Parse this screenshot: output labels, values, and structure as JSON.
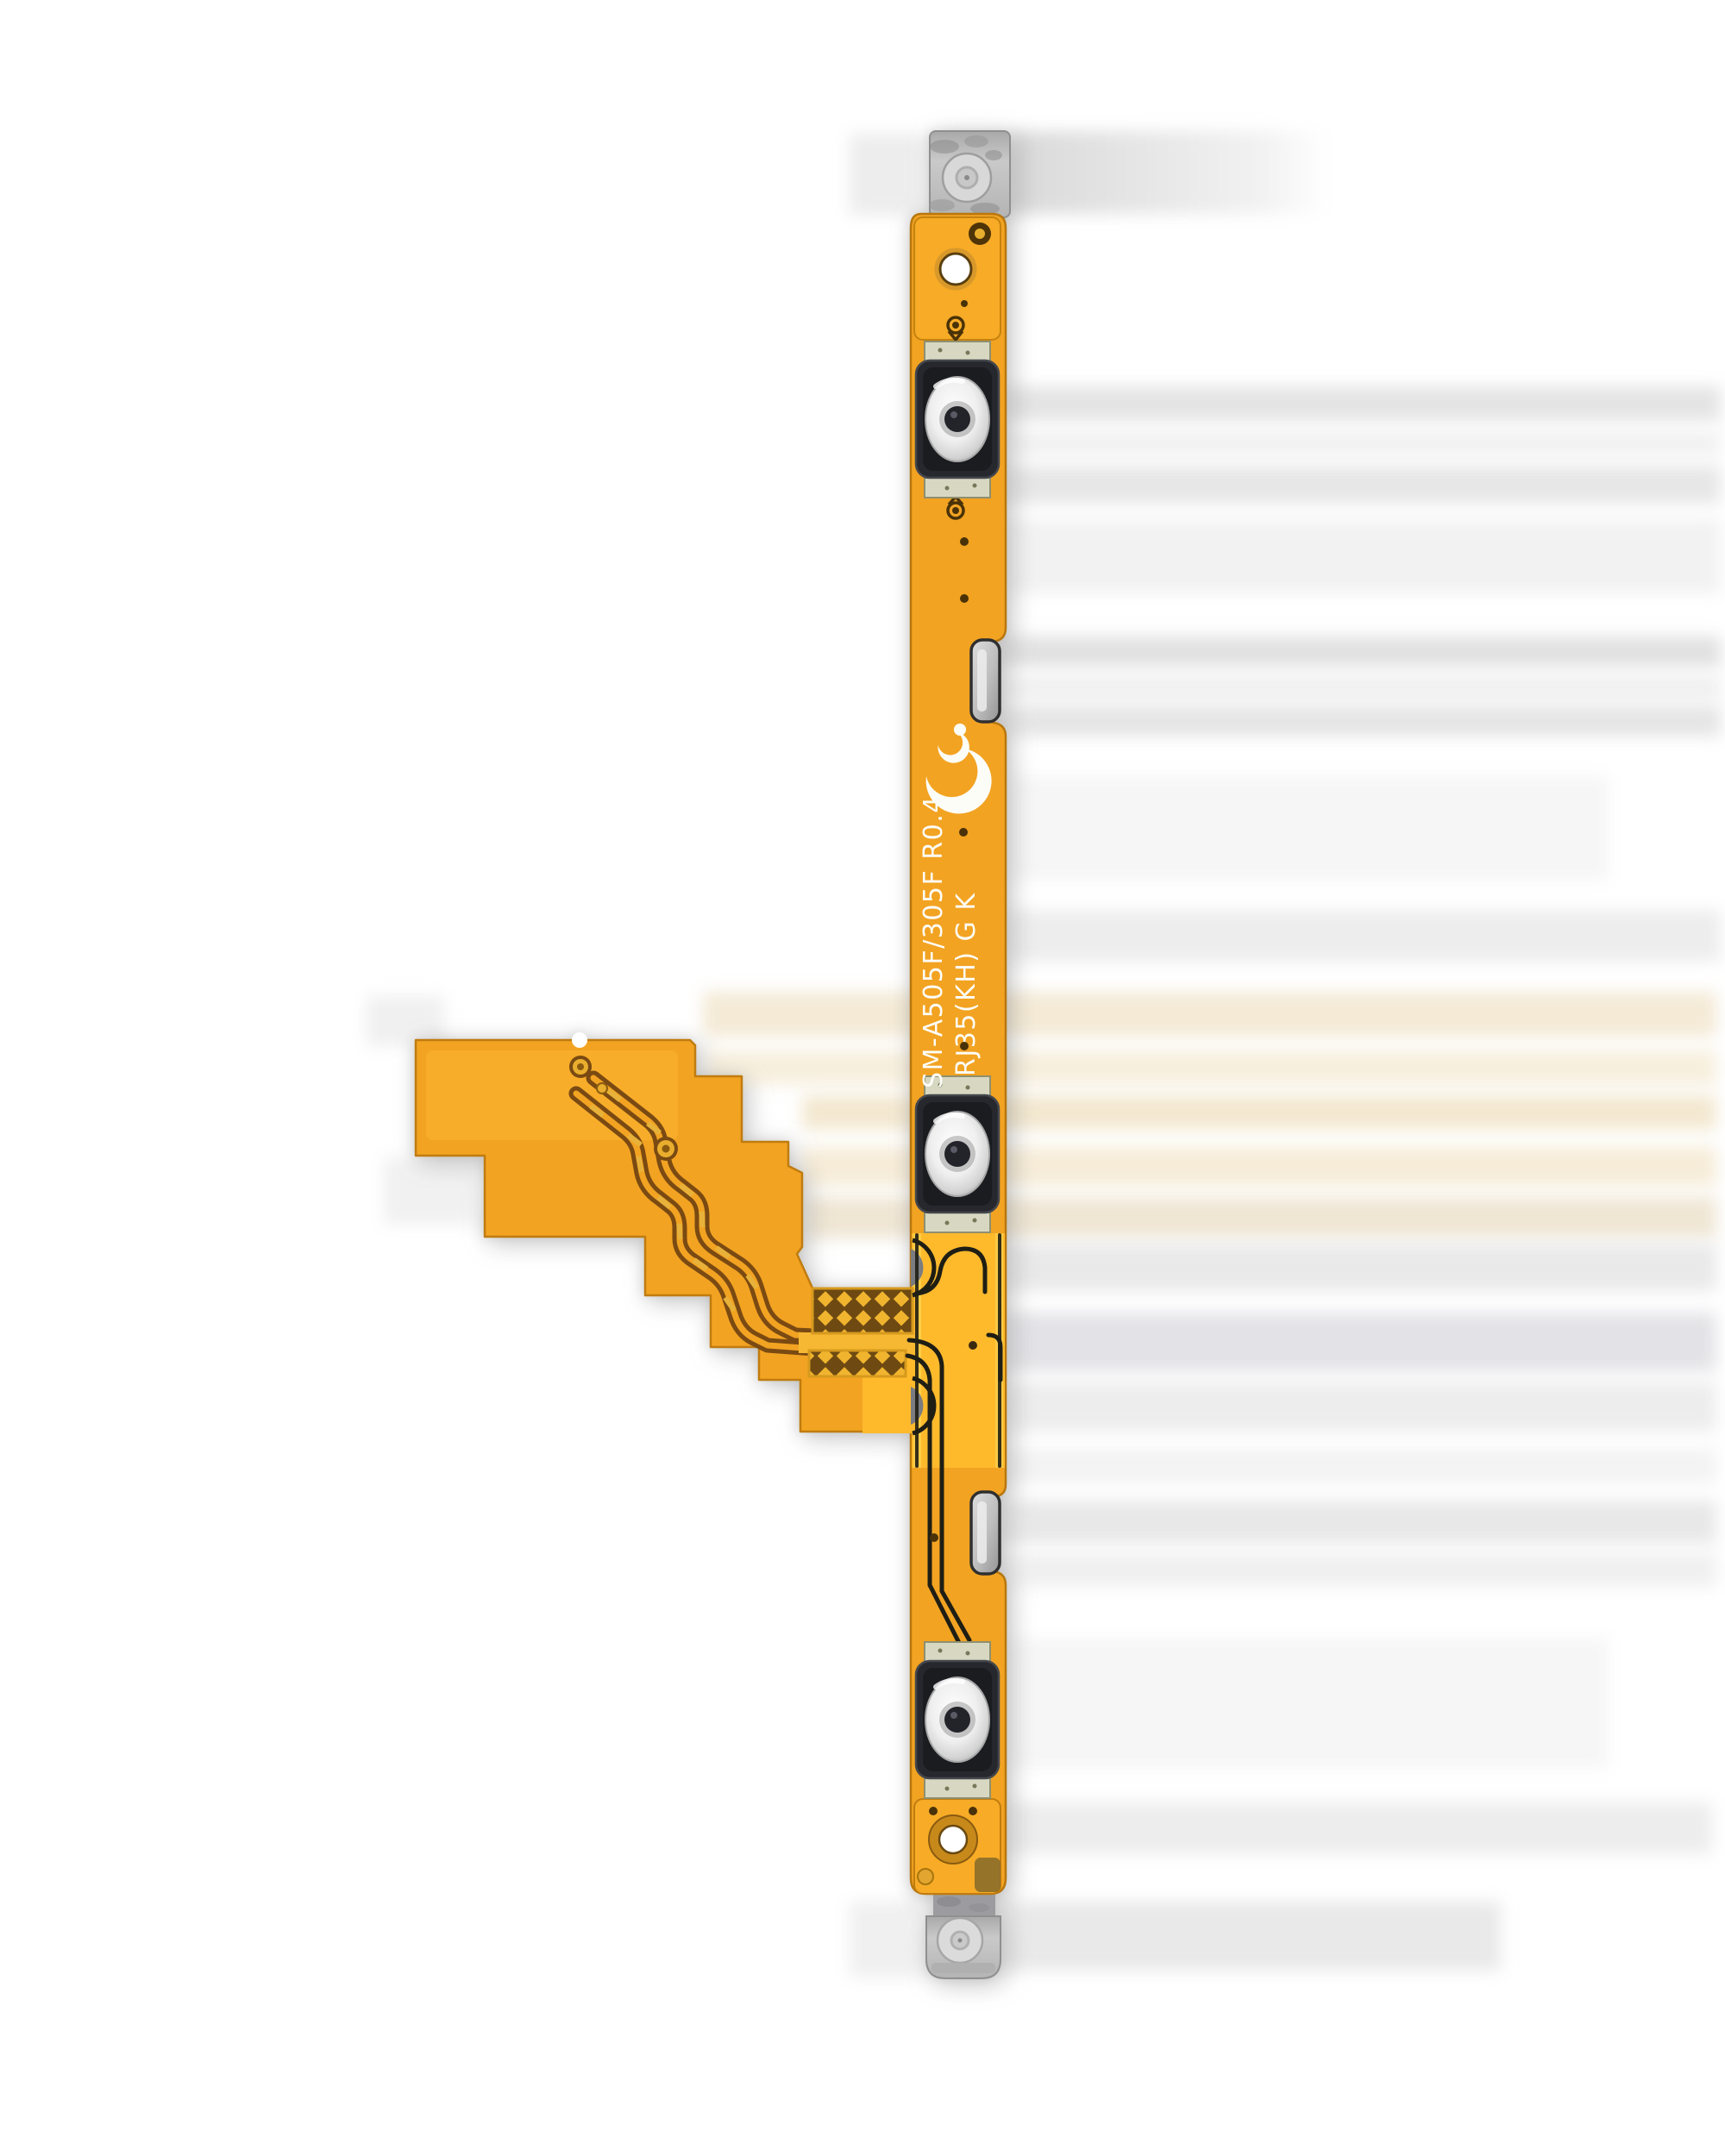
{
  "photo": {
    "subject": "Power and volume side-key flex cable",
    "silkscreen": {
      "line1": "SM-A505F/305F R0.4",
      "line2": "RJ35(KH) G K"
    },
    "features": {
      "dome_switch_count": "3",
      "mounting_bracket_count": "2",
      "side_contact_clip_count": "2"
    },
    "colors": {
      "flex_orange": "#F2A322",
      "flex_gold": "#FFBA2C",
      "trace_brown": "#7A4A12",
      "silkscreen_white": "#FDFDF8",
      "metal_gray": "#C2C2C2",
      "switch_black": "#26282D",
      "background": "#FFFFFF"
    }
  }
}
